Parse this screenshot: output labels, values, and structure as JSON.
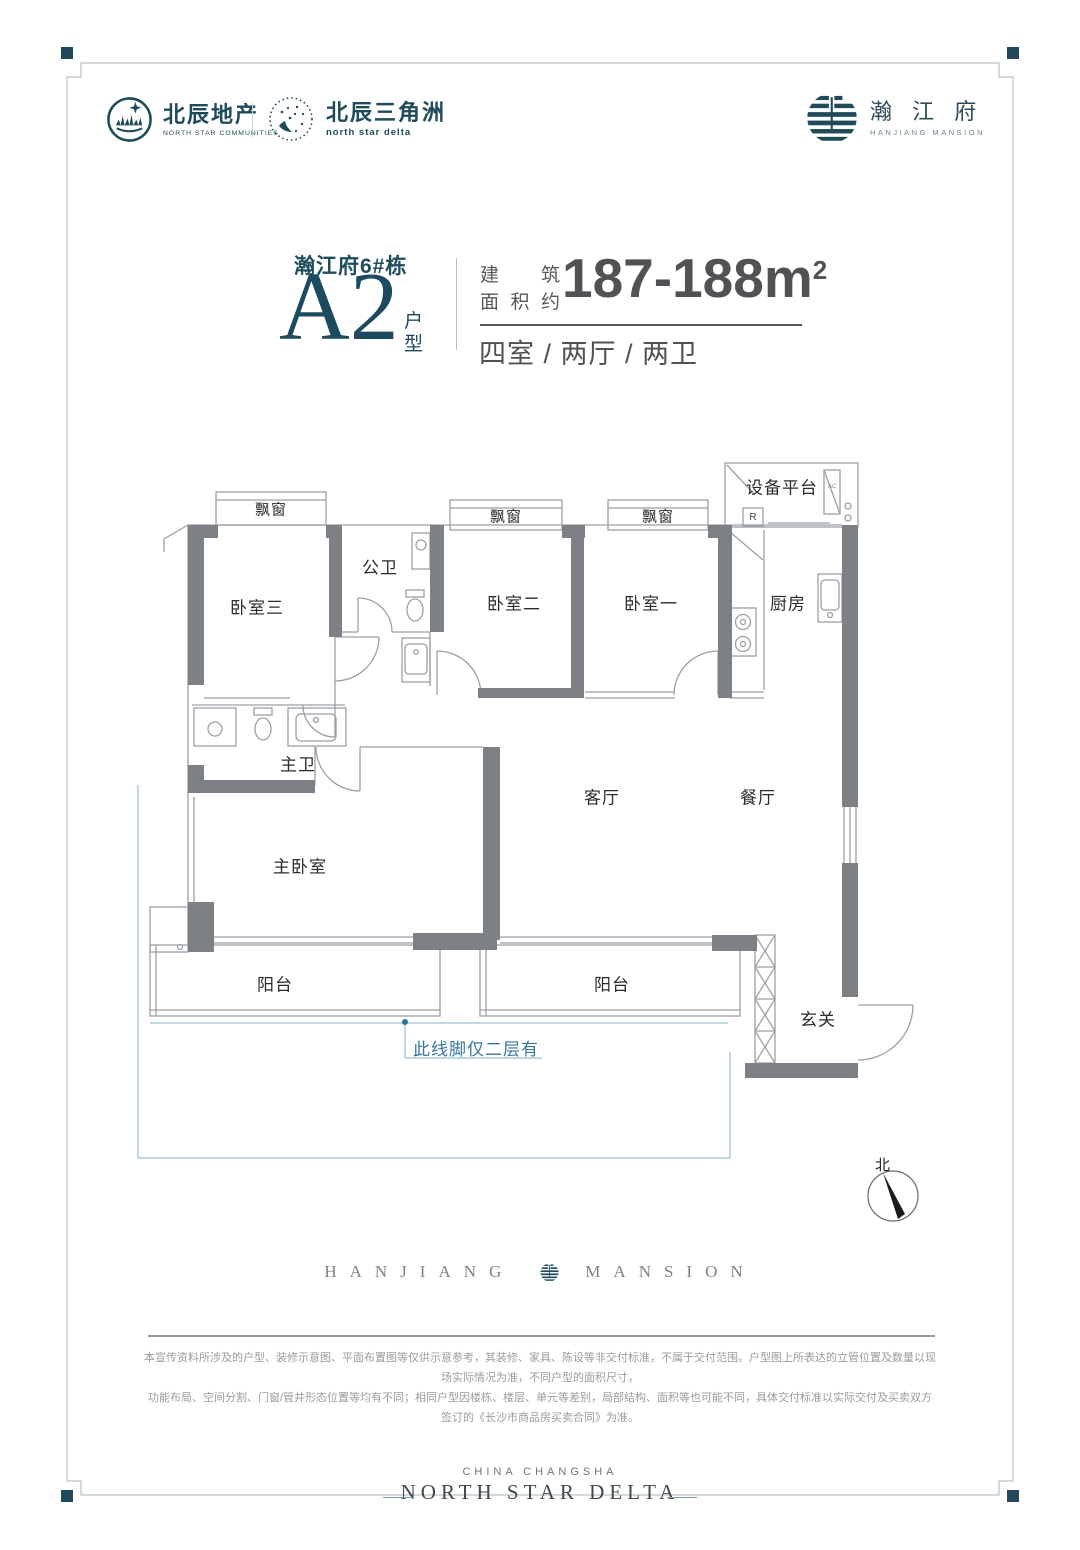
{
  "header": {
    "logo_left": {
      "cn": "北辰地产",
      "en": "NORTH STAR COMMUNITIES"
    },
    "logo_mid": {
      "cn": "北辰三角洲",
      "en": "north star delta"
    },
    "logo_right": {
      "cn": "瀚 江 府",
      "en": "HANJIANG MANSION"
    }
  },
  "title": {
    "building": "瀚江府6#栋",
    "unit": "A2",
    "unit_suffix": "户型",
    "area_label_line1": "建筑",
    "area_label_line2": "面积约",
    "area_value": "187-188m",
    "area_sup": "2",
    "layout": "四室 / 两厅 / 两卫"
  },
  "plan": {
    "rooms": [
      {
        "id": "bay-window-1",
        "label": "飘窗"
      },
      {
        "id": "bay-window-2",
        "label": "飘窗"
      },
      {
        "id": "bay-window-3",
        "label": "飘窗"
      },
      {
        "id": "equipment-platform",
        "label": "设备平台"
      },
      {
        "id": "bedroom-3",
        "label": "卧室三"
      },
      {
        "id": "public-bathroom",
        "label": "公卫"
      },
      {
        "id": "bedroom-2",
        "label": "卧室二"
      },
      {
        "id": "bedroom-1",
        "label": "卧室一"
      },
      {
        "id": "kitchen",
        "label": "厨房"
      },
      {
        "id": "master-bathroom",
        "label": "主卫"
      },
      {
        "id": "living-room",
        "label": "客厅"
      },
      {
        "id": "dining-room",
        "label": "餐厅"
      },
      {
        "id": "master-bedroom",
        "label": "主卧室"
      },
      {
        "id": "balcony-left",
        "label": "阳台"
      },
      {
        "id": "balcony-right",
        "label": "阳台"
      },
      {
        "id": "foyer",
        "label": "玄关"
      }
    ],
    "riser_label": "R",
    "ac_label": "AC",
    "note": "此线脚仅二层有",
    "compass_label": "北"
  },
  "brand_row": {
    "left": "HANJIANG",
    "right": "MANSION"
  },
  "disclaimer": {
    "line1": "本宣传资料所涉及的户型、装修示意图、平面布置图等仅供示意参考，其装修、家具、陈设等非交付标准，不属于交付范围。户型图上所表达的立管位置及数量以现场实际情况为准，不同户型的面积尺寸，",
    "line2": "功能布局、空间分割、门窗/管井形态位置等均有不同；相同户型因楼栋、楼层、单元等差别，局部结构、面积等也可能不同，具体交付标准以实际交付及买卖双方签订的《长沙市商品房买卖合同》为准。"
  },
  "footer": {
    "line1": "CHINA CHANGSHA",
    "line2": "NORTH STAR DELTA"
  }
}
